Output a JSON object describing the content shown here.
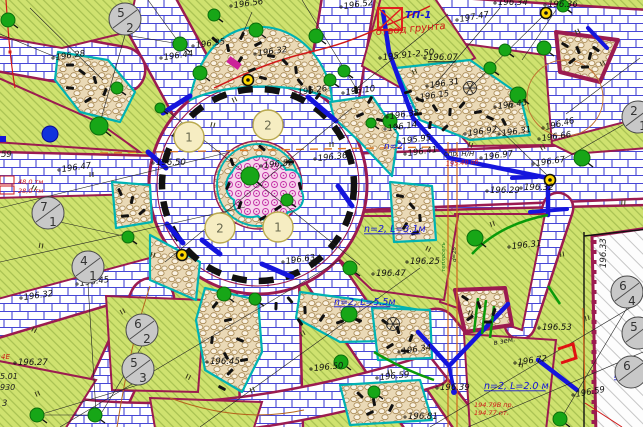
{
  "map": {
    "kind": "landscape-improvement-plan",
    "colors": {
      "lawn": "#cfe26f",
      "lawn_hatch": "#a3bd4e",
      "path_border": "#9b1b50",
      "brick_line": "#4646d6",
      "pebble_bg": "#ead9b6",
      "flowerbed": "#c32fa5",
      "bed_outline": "#00b2b2",
      "pipe_blue": "#1515dd",
      "note_blue": "#1414d8",
      "note_red": "#d01818",
      "utility_orange": "#d2691e",
      "bush_green": "#17a617"
    },
    "elevation_labels": [
      {
        "t": "196.28",
        "x": 56,
        "y": 60
      },
      {
        "t": "196.44",
        "x": 164,
        "y": 60
      },
      {
        "t": "196.35",
        "x": 196,
        "y": 48
      },
      {
        "t": "196.56",
        "x": 234,
        "y": 8
      },
      {
        "t": "196.32",
        "x": 258,
        "y": 56
      },
      {
        "t": "196.26",
        "x": 298,
        "y": 95
      },
      {
        "t": "196.10",
        "x": 346,
        "y": 95
      },
      {
        "t": "196.52",
        "x": 344,
        "y": 9
      },
      {
        "t": "195.91-2.50",
        "x": 383,
        "y": 60,
        "rot": -6
      },
      {
        "t": "197.47",
        "x": 460,
        "y": 22,
        "rot": -10
      },
      {
        "t": "196.34",
        "x": 498,
        "y": 5,
        "rot": 0
      },
      {
        "t": "196.36",
        "x": 548,
        "y": 7,
        "rot": 0
      },
      {
        "t": "196.07",
        "x": 428,
        "y": 60,
        "rot": 0,
        "u": 1
      },
      {
        "t": "196.31",
        "x": 430,
        "y": 88
      },
      {
        "t": "196.15",
        "x": 420,
        "y": 100
      },
      {
        "t": "196.43",
        "x": 498,
        "y": 109
      },
      {
        "t": "196.38",
        "x": 390,
        "y": 119
      },
      {
        "t": "196.14",
        "x": 388,
        "y": 131
      },
      {
        "t": "195.95",
        "x": 402,
        "y": 144
      },
      {
        "t": "196.41",
        "x": 408,
        "y": 156
      },
      {
        "t": "196.92",
        "x": 468,
        "y": 136
      },
      {
        "t": "196.31",
        "x": 502,
        "y": 136
      },
      {
        "t": "196.46",
        "x": 546,
        "y": 130,
        "rot": -14
      },
      {
        "t": "196.66",
        "x": 542,
        "y": 141
      },
      {
        "t": "196.97",
        "x": 484,
        "y": 160
      },
      {
        "t": "196.67",
        "x": 536,
        "y": 166
      },
      {
        "t": "196.29",
        "x": 490,
        "y": 193,
        "rot": 0
      },
      {
        "t": "196.32",
        "x": 524,
        "y": 190,
        "rot": 0
      },
      {
        "t": "196.50",
        "x": 156,
        "y": 165,
        "rot": 0
      },
      {
        "t": "196.47",
        "x": 62,
        "y": 172
      },
      {
        "t": "196.52",
        "x": 264,
        "y": 168,
        "rot": -6
      },
      {
        "t": "196.36",
        "x": 318,
        "y": 161,
        "rot": -6
      },
      {
        "t": "196.63",
        "x": 286,
        "y": 264
      },
      {
        "t": "196.25",
        "x": 410,
        "y": 264,
        "rot": 0
      },
      {
        "t": "196.47",
        "x": 376,
        "y": 276,
        "rot": 0
      },
      {
        "t": "196.31",
        "x": 512,
        "y": 249,
        "rot": -6
      },
      {
        "t": "196.53",
        "x": 542,
        "y": 330,
        "rot": 0
      },
      {
        "t": "196.72",
        "x": 518,
        "y": 365,
        "rot": -8
      },
      {
        "t": "196.39",
        "x": 440,
        "y": 390,
        "rot": 0
      },
      {
        "t": "196.59",
        "x": 576,
        "y": 397,
        "rot": -10
      },
      {
        "t": "196.45",
        "x": 80,
        "y": 286
      },
      {
        "t": "196.32",
        "x": 24,
        "y": 300
      },
      {
        "t": "196.27",
        "x": 18,
        "y": 365,
        "rot": 0
      },
      {
        "t": "196.45",
        "x": 210,
        "y": 364,
        "rot": 0
      },
      {
        "t": "196.50",
        "x": 314,
        "y": 371,
        "rot": -6
      },
      {
        "t": "196.59",
        "x": 380,
        "y": 380,
        "rot": -6
      },
      {
        "t": "196.34",
        "x": 402,
        "y": 354,
        "rot": -8
      },
      {
        "t": "196.81",
        "x": 408,
        "y": 419,
        "rot": 0
      }
    ],
    "blue_notes": [
      {
        "t": "ТП-1",
        "x": 405,
        "y": 18,
        "size": 10,
        "b": 1
      },
      {
        "t": "n=2,",
        "x": 384,
        "y": 149,
        "size": 9
      },
      {
        "t": "n=2, L=3.1м",
        "x": 364,
        "y": 232,
        "size": 9.5,
        "u": 1
      },
      {
        "t": "n=2, L=5.5м",
        "x": 334,
        "y": 305,
        "size": 9.5,
        "u": 1
      },
      {
        "t": "n=2, L=2.0 м",
        "x": 484,
        "y": 389,
        "size": 9.5,
        "u": 1
      },
      {
        "t": "n=4",
        "x": 614,
        "y": 378,
        "size": 9.5,
        "u": 1
      }
    ],
    "red_notes": [
      {
        "t": "отвод грунта",
        "x": 376,
        "y": 35,
        "size": 10,
        "rot": -5
      },
      {
        "t": "48,0 тм",
        "x": 18,
        "y": 184,
        "size": 6.5
      },
      {
        "t": "28,0 тм",
        "x": 18,
        "y": 193,
        "size": 6.5
      },
      {
        "t": "195.40 об.",
        "x": 446,
        "y": 166,
        "size": 6.5,
        "rot": -4
      },
      {
        "t": "194.79В пр.",
        "x": 474,
        "y": 407,
        "size": 6.5
      },
      {
        "t": "194.77 пт.",
        "x": 474,
        "y": 415,
        "size": 6.5
      },
      {
        "t": "4Е",
        "x": 1,
        "y": 359,
        "size": 7
      }
    ],
    "misc_labels": [
      {
        "t": "спр. Н/Н",
        "x": 444,
        "y": 156,
        "size": 7
      },
      {
        "t": "в зем.",
        "x": 494,
        "y": 345,
        "size": 7,
        "rot": -10
      },
      {
        "t": "59",
        "x": 1,
        "y": 157,
        "size": 8.5
      },
      {
        "t": "5.01",
        "x": 0,
        "y": 379,
        "size": 8
      },
      {
        "t": "930",
        "x": 0,
        "y": 390,
        "size": 8
      },
      {
        "t": "3",
        "x": 2,
        "y": 406,
        "size": 8.5
      },
      {
        "t": "196.33",
        "x": 606,
        "y": 268,
        "size": 8.5,
        "rot": -90
      },
      {
        "t": "теплосеть",
        "x": 445,
        "y": 272,
        "size": 5.5,
        "rot": -90,
        "c": "#1a7a1a"
      },
      {
        "t": "d=25",
        "x": 456,
        "y": 262,
        "size": 5.5,
        "rot": -90
      }
    ],
    "gray_circles": [
      {
        "a": "5",
        "b": "2",
        "x": 125,
        "y": 19
      },
      {
        "a": "7",
        "b": "1",
        "x": 48,
        "y": 213
      },
      {
        "a": "4",
        "b": "1",
        "x": 88,
        "y": 267
      },
      {
        "a": "6",
        "b": "2",
        "x": 142,
        "y": 330
      },
      {
        "a": "5",
        "b": "3",
        "x": 138,
        "y": 369
      },
      {
        "a": "2",
        "b": "1",
        "x": 638,
        "y": 117
      },
      {
        "a": "6",
        "b": "4",
        "x": 627,
        "y": 292
      },
      {
        "a": "5",
        "b": "",
        "x": 638,
        "y": 333
      },
      {
        "a": "6",
        "b": "",
        "x": 631,
        "y": 372
      }
    ],
    "yellow_circles": [
      {
        "n": "1",
        "x": 189,
        "y": 137
      },
      {
        "n": "2",
        "x": 268,
        "y": 125
      },
      {
        "n": "2",
        "x": 220,
        "y": 228
      },
      {
        "n": "1",
        "x": 278,
        "y": 227
      }
    ],
    "symbols": [
      {
        "name": "transformer-box-icon",
        "x": 378,
        "y": 8
      },
      {
        "name": "junction-marker",
        "x": 248,
        "y": 80
      },
      {
        "name": "junction-marker",
        "x": 550,
        "y": 180
      },
      {
        "name": "junction-marker",
        "x": 182,
        "y": 255
      },
      {
        "name": "junction-marker",
        "x": 546,
        "y": 13
      },
      {
        "name": "hydrant-blue-circle",
        "x": 50,
        "y": 134
      },
      {
        "name": "pink-gate-marker",
        "x": 234,
        "y": 63
      },
      {
        "name": "red-flag-marker",
        "x": 565,
        "y": 352
      },
      {
        "name": "conifer-tree-icon",
        "x": 470,
        "y": 88
      },
      {
        "name": "conifer-tree-icon",
        "x": 393,
        "y": 324
      }
    ]
  }
}
